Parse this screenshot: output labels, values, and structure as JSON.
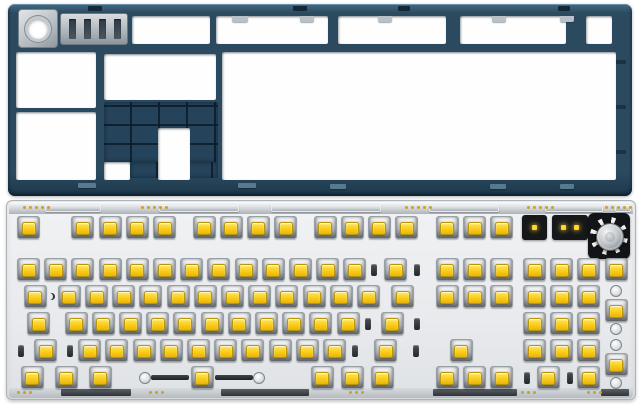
{
  "meta": {
    "description": "Product photo of a barebones mechanical keyboard kit: dark slate-blue bottom case shown from the inside (top) and a white plate/PCB assembly fully populated with yellow-stem switches and a rotary knob (bottom)",
    "background_color": "#ffffff"
  },
  "colors": {
    "case_body": "#2b4a60",
    "case_rib_dark": "#182f41",
    "case_grid": "#25435a",
    "metal_silver": "#b9c0c5",
    "plate": "#eceef0",
    "plate_chrome_edge": "#d9dde0",
    "switch_housing": "#d8dbde",
    "switch_stem_yellow": "#f8ca14",
    "stab_wire_black": "#2a2e33",
    "indicator_led_yellow": "#ffd62a",
    "knob_metal": "#c4c9cd",
    "pcb_gold_dot": "#c9a227"
  },
  "case": {
    "label": "bottom case interior (upside-down)",
    "windows": [
      {
        "n": "top-strip-window",
        "x": 132,
        "y": 16,
        "w": 78,
        "h": 28
      },
      {
        "n": "top-strip-window",
        "x": 216,
        "y": 16,
        "w": 112,
        "h": 28
      },
      {
        "n": "top-strip-window",
        "x": 338,
        "y": 16,
        "w": 108,
        "h": 28
      },
      {
        "n": "top-strip-window",
        "x": 460,
        "y": 16,
        "w": 106,
        "h": 28
      },
      {
        "n": "top-strip-window",
        "x": 586,
        "y": 16,
        "w": 26,
        "h": 28
      },
      {
        "n": "left-column-window-upper",
        "x": 16,
        "y": 52,
        "w": 80,
        "h": 56
      },
      {
        "n": "left-column-window-lower",
        "x": 16,
        "y": 112,
        "w": 80,
        "h": 68
      },
      {
        "n": "mid-upper-window",
        "x": 104,
        "y": 54,
        "w": 112,
        "h": 46
      },
      {
        "n": "main-cavity-window",
        "x": 222,
        "y": 52,
        "w": 394,
        "h": 128
      },
      {
        "n": "battery-bay-cutout",
        "x": 158,
        "y": 128,
        "w": 32,
        "h": 52
      },
      {
        "n": "below-grid-window",
        "x": 104,
        "y": 162,
        "w": 26,
        "h": 18
      }
    ],
    "battery_grid": {
      "n": "battery-rib-grid",
      "x": 104,
      "y": 102,
      "w": 114,
      "h": 60,
      "legs": [
        {
          "x": 130,
          "y": 162,
          "w": 30,
          "h": 16
        },
        {
          "x": 185,
          "y": 162,
          "w": 33,
          "h": 16
        }
      ]
    },
    "knob_mount": {
      "n": "knob-mount-plate",
      "x": 18,
      "y": 9,
      "w": 38,
      "h": 37
    },
    "slotted_block": {
      "n": "connector-block",
      "x": 60,
      "y": 13,
      "w": 66,
      "h": 30,
      "slots": 4
    },
    "top_slots": [
      [
        88,
        6,
        14,
        5
      ],
      [
        293,
        6,
        14,
        5
      ],
      [
        398,
        6,
        12,
        5
      ],
      [
        558,
        6,
        12,
        5
      ]
    ],
    "bottom_tabs": [
      [
        78,
        183,
        18,
        5
      ],
      [
        238,
        183,
        18,
        5
      ],
      [
        330,
        184,
        16,
        5
      ],
      [
        490,
        184,
        16,
        5
      ],
      [
        560,
        184,
        14,
        5
      ]
    ],
    "right_notches": [
      [
        616,
        60,
        10,
        4
      ],
      [
        616,
        105,
        10,
        4
      ],
      [
        616,
        150,
        10,
        4
      ]
    ],
    "window_tabs": [
      [
        232,
        16,
        16,
        6
      ],
      [
        300,
        16,
        14,
        6
      ],
      [
        378,
        16,
        14,
        6
      ],
      [
        492,
        16,
        14,
        6
      ],
      [
        560,
        16,
        14,
        6
      ]
    ]
  },
  "pcb": {
    "label": "plate and PCB assembly with switches installed",
    "unit_px": 27.2,
    "origin_x": 14,
    "row_top_start": 214,
    "row_pitch": 27,
    "switch_count": 103,
    "rows": [
      {
        "y": 214,
        "items": [
          {
            "t": "sw",
            "n": "esc-switch"
          },
          {
            "t": "gap",
            "u": 1
          },
          {
            "t": "sw",
            "count": 4,
            "n": "f1-f4-switch"
          },
          {
            "t": "gap",
            "u": 0.45
          },
          {
            "t": "sw",
            "count": 4,
            "n": "f5-f8-switch"
          },
          {
            "t": "gap",
            "u": 0.45
          },
          {
            "t": "sw",
            "count": 4,
            "n": "f9-f12-switch"
          },
          {
            "t": "gap",
            "u": 0.5
          },
          {
            "t": "sw",
            "count": 3,
            "n": "nav-top-switch"
          },
          {
            "t": "gap",
            "u": 0.2
          },
          {
            "t": "ledsq",
            "u": 1,
            "n": "indicator-led-window"
          },
          {
            "t": "gap",
            "u": 0.15
          },
          {
            "t": "ledbar",
            "u": 1.3,
            "n": "led-strip-window"
          },
          {
            "t": "knob",
            "u": 1.55,
            "n": "rotary-encoder-knob"
          }
        ]
      },
      {
        "y": 256,
        "items": [
          {
            "t": "sw",
            "count": 13,
            "n": "number-row-switch"
          },
          {
            "t": "stab",
            "u": 2,
            "n": "backspace-switch"
          },
          {
            "t": "gap",
            "u": 0.4
          },
          {
            "t": "sw",
            "count": 3,
            "n": "nav-mid-switch"
          },
          {
            "t": "gap",
            "u": 0.2
          },
          {
            "t": "sw",
            "count": 4,
            "n": "numpad-top-switch"
          }
        ]
      },
      {
        "y": 283,
        "items": [
          {
            "t": "sw",
            "u": 1.5,
            "n": "tab-switch"
          },
          {
            "t": "sw",
            "count": 12,
            "n": "qwerty-row-switch"
          },
          {
            "t": "sw",
            "u": 1.5,
            "n": "backslash-switch"
          },
          {
            "t": "gap",
            "u": 0.4
          },
          {
            "t": "sw",
            "count": 3,
            "n": "nav-low-switch"
          },
          {
            "t": "gap",
            "u": 0.2
          },
          {
            "t": "sw",
            "count": 3,
            "n": "numpad-789-switch"
          },
          {
            "t": "vstab",
            "u": 1,
            "n": "numpad-plus-switch"
          }
        ]
      },
      {
        "y": 310,
        "items": [
          {
            "t": "sw",
            "u": 1.75,
            "n": "capslock-switch"
          },
          {
            "t": "sw",
            "count": 11,
            "n": "home-row-switch"
          },
          {
            "t": "stab",
            "u": 2.25,
            "n": "enter-switch"
          },
          {
            "t": "gap",
            "u": 3.6
          },
          {
            "t": "sw",
            "count": 3,
            "n": "numpad-456-switch"
          }
        ]
      },
      {
        "y": 337,
        "items": [
          {
            "t": "stab",
            "u": 2.25,
            "n": "left-shift-switch"
          },
          {
            "t": "sw",
            "count": 10,
            "n": "bottom-alpha-switch"
          },
          {
            "t": "stab",
            "u": 2.75,
            "n": "right-shift-switch"
          },
          {
            "t": "gap",
            "u": 0.9
          },
          {
            "t": "sw",
            "n": "up-arrow-switch"
          },
          {
            "t": "gap",
            "u": 1.7
          },
          {
            "t": "sw",
            "count": 3,
            "n": "numpad-123-switch"
          },
          {
            "t": "vstab",
            "u": 1,
            "n": "numpad-enter-switch"
          }
        ]
      },
      {
        "y": 364,
        "items": [
          {
            "t": "sw",
            "u": 1.25,
            "count": 3,
            "n": "left-modifier-switch"
          },
          {
            "t": "space",
            "u": 6.25,
            "n": "spacebar-switch"
          },
          {
            "t": "gap",
            "u": 0.75
          },
          {
            "t": "sw",
            "u": 1.1,
            "count": 3,
            "n": "right-modifier-switch"
          },
          {
            "t": "gap",
            "u": 1.35
          },
          {
            "t": "sw",
            "count": 3,
            "n": "arrow-switch"
          },
          {
            "t": "gap",
            "u": 0.2
          },
          {
            "t": "stab",
            "u": 2,
            "n": "numpad-0-switch"
          },
          {
            "t": "sw",
            "n": "numpad-dot-switch"
          }
        ]
      }
    ],
    "top_edge": {
      "bars": [
        [
          36,
          56
        ],
        [
          150,
          80
        ],
        [
          262,
          110
        ],
        [
          420,
          70
        ],
        [
          536,
          58
        ],
        [
          606,
          16
        ]
      ],
      "dot_groups": [
        14,
        132,
        396,
        518,
        596
      ]
    },
    "bottom_edge": {
      "tabs": [
        [
          52,
          70
        ],
        [
          212,
          88
        ],
        [
          424,
          84
        ],
        [
          592,
          28
        ]
      ],
      "dot_groups": [
        8,
        140,
        340,
        512,
        578
      ]
    },
    "marks": [
      {
        "type": "crescent",
        "n": "crescent-mark",
        "x": 47,
        "y": 292
      }
    ]
  }
}
